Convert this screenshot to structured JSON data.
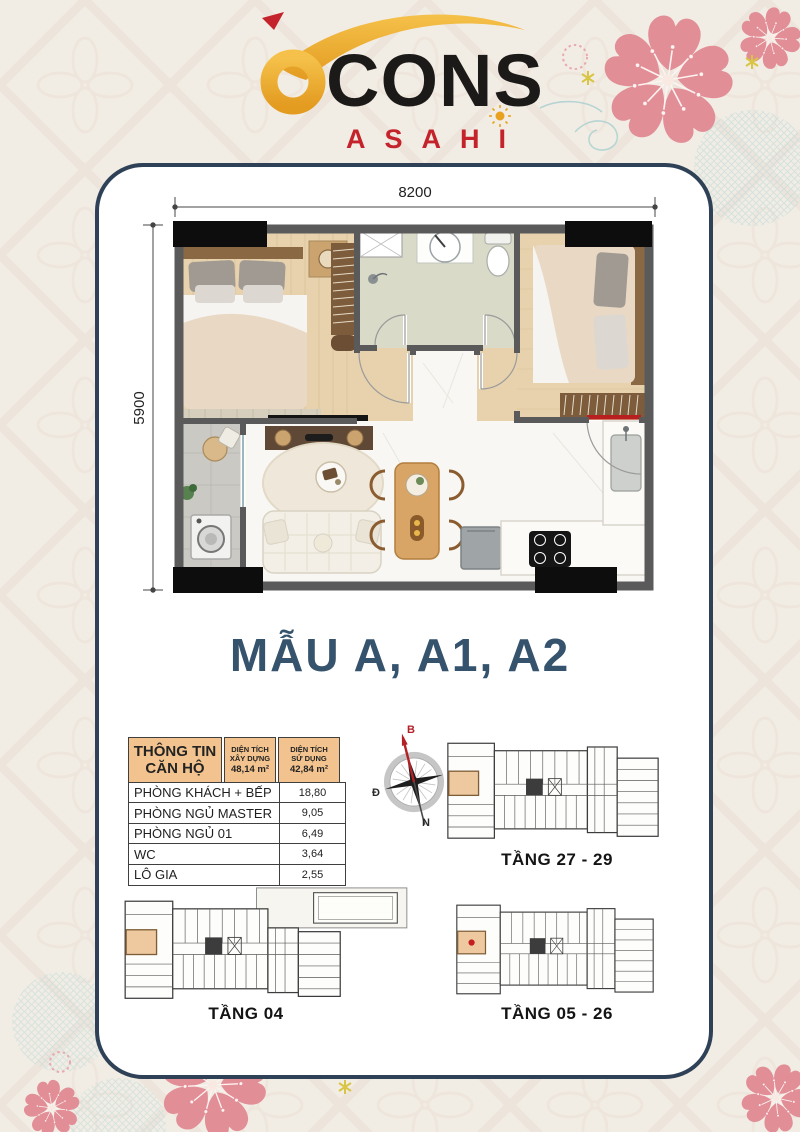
{
  "brand": {
    "logo_b": "b",
    "logo_main": "CONS",
    "logo_sub": "ASAHI"
  },
  "plan": {
    "width_label": "8200",
    "height_label": "5900",
    "title": "MẪU A, A1, A2"
  },
  "unit_table": {
    "header": {
      "col1_line1": "THÔNG TIN",
      "col1_line2": "CĂN HỘ",
      "col2_line1": "DIỆN TÍCH",
      "col2_line2": "XÂY DỰNG",
      "col2_value": "48,14 m²",
      "col3_line1": "DIỆN TÍCH",
      "col3_line2": "SỬ DỤNG",
      "col3_value": "42,84 m²"
    },
    "rows": [
      {
        "name": "PHÒNG KHÁCH + BẾP",
        "value": "18,80"
      },
      {
        "name": "PHÒNG NGỦ MASTER",
        "value": "9,05"
      },
      {
        "name": "PHÒNG NGỦ 01",
        "value": "6,49"
      },
      {
        "name": "WC",
        "value": "3,64"
      },
      {
        "name": "LÔ GIA",
        "value": "2,55"
      }
    ]
  },
  "compass": {
    "north": "B",
    "south": "N",
    "west": "T",
    "east": "Đ"
  },
  "floors": [
    {
      "label": "TẦNG 27 - 29"
    },
    {
      "label": "TẦNG 04"
    },
    {
      "label": "TẦNG 05 - 26"
    }
  ],
  "colors": {
    "background": "#f2ede4",
    "card_border": "#2e4156",
    "title_blue": "#35536d",
    "table_header": "#f2c38e",
    "logo_gold": "#eeb23c",
    "logo_red": "#c5232b",
    "sakura_pink": "#e28e97",
    "highlight_unit": "#eec9a0",
    "entry_door_red": "#b81f1f"
  }
}
